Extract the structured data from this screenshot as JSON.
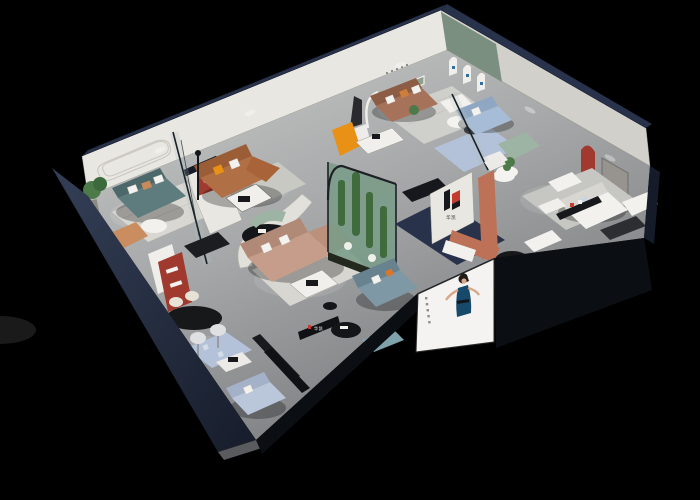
{
  "meta": {
    "title": "3D cutaway dollhouse render of a furniture showroom",
    "view": "isometric aerial cutaway, black background",
    "canvas": {
      "width": 700,
      "height": 500
    }
  },
  "brand": {
    "name_cn": "华凯",
    "logo_mark": "H",
    "logo_black": "#17181b",
    "logo_red": "#c63b2f"
  },
  "signs": {
    "partition_logo_text": "华凯",
    "wall_strip_text": "华凯"
  },
  "poster": {
    "subject": "fashion model in dark blue dress",
    "panel_color": "#f4f3f1",
    "dress_color": "#17496b",
    "skin_color": "#d8a787",
    "hair_color": "#1d1a18"
  },
  "palette": {
    "bg": "#000000",
    "navyCap": "#28324a",
    "navyDeep": "#151b29",
    "fasciaBlack": "#0b0e13",
    "wallWhite": "#e9e7e2",
    "wallShade": "#d2d0ca",
    "wallDark": "#b5b3ad",
    "floor": "#a8aaab",
    "floorLight": "#cfcfcd",
    "floorDark": "#7f8184",
    "exteriorGray": "#5a5b5f",
    "greenWall": "#7b8f80",
    "tealSofa": "#5e7c7e",
    "caramelSofa": "#b06f44",
    "brownSofa": "#a6735a",
    "tanSectional": "#c59d8a",
    "blueSofa": "#a7bcd6",
    "greenChaise": "#9db3a3",
    "grayBlueSofa": "#7e98a6",
    "tealOttoman": "#7fa3ab",
    "lightBlueSofa": "#bac7da",
    "orangeAccent": "#e89114",
    "redAccent": "#a03a2e",
    "terracotta": "#bd7257",
    "plantGreen": "#4c7a48",
    "glassTint": "#9cc4b8",
    "blackFurniture": "#141619",
    "whiteFurniture": "#f2f1ee",
    "creamRug": "#d9d7d1",
    "blueRug": "#b3c2d8"
  },
  "rooms": [
    {
      "name": "teal-lounge",
      "items": [
        "teal sofa",
        "round white coffee table",
        "potted plant",
        "striped rug",
        "tan armchair",
        "curved wall moulding"
      ]
    },
    {
      "name": "caramel-lounge",
      "items": [
        "caramel leather sofa",
        "orange pillow",
        "white coffee table",
        "black floor lamp",
        "red arched niche",
        "glass partition"
      ]
    },
    {
      "name": "center-gallery",
      "items": [
        "brown leather sofa",
        "white armchair",
        "statue on pedestal",
        "arched floor lamp",
        "orange chaise pair",
        "white desk",
        "green display niche"
      ]
    },
    {
      "name": "blue-lounge",
      "items": [
        "light blue sofa",
        "green chaise",
        "round table with plant",
        "blue rug",
        "green arch wall with three arched panels"
      ]
    },
    {
      "name": "white-suite",
      "items": [
        "white sofa set",
        "black display console",
        "red arched niche",
        "gray door panel",
        "white bench",
        "black round rug",
        "round dining table"
      ]
    },
    {
      "name": "central-display",
      "items": [
        "tan sectional sofa",
        "marble coffee table",
        "curved partition dining nook",
        "black oval table",
        "teal curved bench",
        "cactus glass atrium"
      ]
    },
    {
      "name": "front-lounge",
      "items": [
        "gray-blue leather sofa",
        "teal ottoman",
        "black round side table",
        "brand wall strip"
      ]
    },
    {
      "name": "retail-strip",
      "items": [
        "red display cabinet",
        "black oval bar table",
        "bar stools",
        "pixel blue rug",
        "light blue sofa",
        "black benches",
        "logo partition",
        "terracotta chaise"
      ]
    }
  ]
}
